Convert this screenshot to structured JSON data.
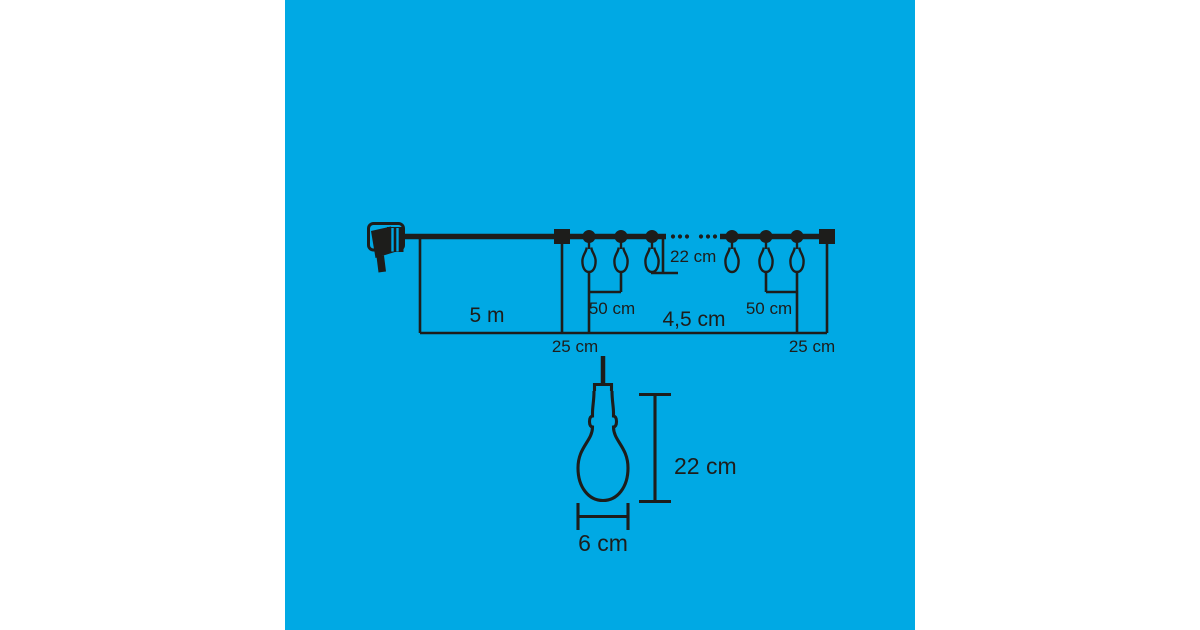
{
  "colors": {
    "page-bg": "#ffffff",
    "panel-bg": "#00a9e4",
    "ink": "#1d1d1b"
  },
  "diagram": {
    "string_section": {
      "lead_length_label": "5 m",
      "lead_offset_label": "25 cm",
      "spacing_left_label": "50 cm",
      "drop_label": "22 cm",
      "total_length_label": "4,5 cm",
      "spacing_right_label": "50 cm",
      "end_offset_label": "25 cm"
    },
    "bulb_detail": {
      "height_label": "22 cm",
      "width_label": "6 cm"
    },
    "icons": {
      "plug": "power-plug-icon",
      "connector": "connector-block-icon",
      "bulb_clip": "bulb-clip-icon",
      "pendant_bulb": "pendant-bulb-icon",
      "end_cap": "end-cap-icon",
      "wire_break": "wire-break-dots"
    }
  }
}
